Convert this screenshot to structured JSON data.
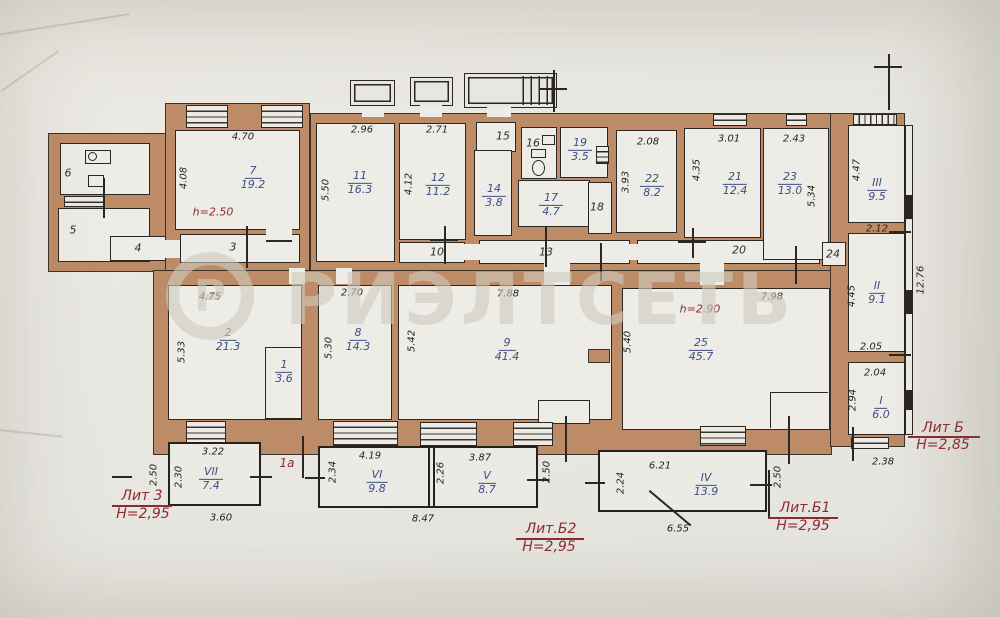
{
  "watermark": {
    "text": "РИЭЛТСЕТЬ",
    "logo_char": "Р"
  },
  "colors": {
    "wall": "#bd8c66",
    "paper": "#e8e7e1",
    "line": "#2b2722",
    "room_label": "#3d4e82",
    "annotation_red": "#8e2b31"
  },
  "room_labels": [
    {
      "n": "7",
      "a": "19.2",
      "x": 253,
      "y": 178
    },
    {
      "n": "11",
      "a": "16.3",
      "x": 360,
      "y": 183
    },
    {
      "n": "12",
      "a": "11.2",
      "x": 438,
      "y": 185
    },
    {
      "n": "14",
      "a": "3.8",
      "x": 494,
      "y": 196
    },
    {
      "n": "19",
      "a": "3.5",
      "x": 580,
      "y": 150
    },
    {
      "n": "17",
      "a": "4.7",
      "x": 551,
      "y": 205
    },
    {
      "n": "22",
      "a": "8.2",
      "x": 652,
      "y": 186
    },
    {
      "n": "21",
      "a": "12.4",
      "x": 735,
      "y": 184
    },
    {
      "n": "23",
      "a": "13.0",
      "x": 790,
      "y": 184
    },
    {
      "n": "III",
      "a": "9.5",
      "x": 877,
      "y": 190
    },
    {
      "n": "II",
      "a": "9.1",
      "x": 877,
      "y": 293
    },
    {
      "n": "I",
      "a": "6.0",
      "x": 881,
      "y": 408
    },
    {
      "n": "2",
      "a": "21.3",
      "x": 228,
      "y": 340
    },
    {
      "n": "1",
      "a": "3.6",
      "x": 284,
      "y": 372
    },
    {
      "n": "8",
      "a": "14.3",
      "x": 358,
      "y": 340
    },
    {
      "n": "9",
      "a": "41.4",
      "x": 507,
      "y": 350
    },
    {
      "n": "25",
      "a": "45.7",
      "x": 701,
      "y": 350
    },
    {
      "n": "VII",
      "a": "7.4",
      "x": 211,
      "y": 479
    },
    {
      "n": "VI",
      "a": "9.8",
      "x": 377,
      "y": 482
    },
    {
      "n": "V",
      "a": "8.7",
      "x": 487,
      "y": 483
    },
    {
      "n": "IV",
      "a": "13.9",
      "x": 706,
      "y": 485
    }
  ],
  "plain_labels": [
    {
      "t": "6",
      "x": 68,
      "y": 173
    },
    {
      "t": "5",
      "x": 73,
      "y": 230
    },
    {
      "t": "4",
      "x": 138,
      "y": 248
    },
    {
      "t": "3",
      "x": 233,
      "y": 247
    },
    {
      "t": "10",
      "x": 437,
      "y": 252
    },
    {
      "t": "13",
      "x": 546,
      "y": 252
    },
    {
      "t": "15",
      "x": 503,
      "y": 136
    },
    {
      "t": "16",
      "x": 533,
      "y": 143
    },
    {
      "t": "18",
      "x": 597,
      "y": 207
    },
    {
      "t": "20",
      "x": 739,
      "y": 250
    },
    {
      "t": "24",
      "x": 833,
      "y": 254
    }
  ],
  "dim_labels": [
    {
      "t": "4.70",
      "x": 243,
      "y": 137,
      "r": 0
    },
    {
      "t": "4.08",
      "x": 184,
      "y": 178,
      "r": 1
    },
    {
      "t": "2.96",
      "x": 362,
      "y": 130,
      "r": 0
    },
    {
      "t": "5.50",
      "x": 326,
      "y": 190,
      "r": 1
    },
    {
      "t": "2.71",
      "x": 437,
      "y": 130,
      "r": 0
    },
    {
      "t": "4.12",
      "x": 409,
      "y": 184,
      "r": 1
    },
    {
      "t": "2.08",
      "x": 648,
      "y": 142,
      "r": 0
    },
    {
      "t": "3.93",
      "x": 626,
      "y": 182,
      "r": 1
    },
    {
      "t": "3.01",
      "x": 729,
      "y": 139,
      "r": 0
    },
    {
      "t": "4.35",
      "x": 697,
      "y": 170,
      "r": 1
    },
    {
      "t": "2.43",
      "x": 794,
      "y": 139,
      "r": 0
    },
    {
      "t": "5.34",
      "x": 812,
      "y": 196,
      "r": 1
    },
    {
      "t": "4.47",
      "x": 857,
      "y": 170,
      "r": 1
    },
    {
      "t": "2.12",
      "x": 877,
      "y": 229,
      "r": 0
    },
    {
      "t": "12.76",
      "x": 921,
      "y": 280,
      "r": 1
    },
    {
      "t": "4.45",
      "x": 852,
      "y": 296,
      "r": 1
    },
    {
      "t": "2.05",
      "x": 871,
      "y": 347,
      "r": 0
    },
    {
      "t": "2.04",
      "x": 875,
      "y": 373,
      "r": 0
    },
    {
      "t": "2.94",
      "x": 853,
      "y": 400,
      "r": 1
    },
    {
      "t": "2.38",
      "x": 883,
      "y": 462,
      "r": 0
    },
    {
      "t": "4.75",
      "x": 210,
      "y": 297,
      "r": 0
    },
    {
      "t": "5.33",
      "x": 182,
      "y": 352,
      "r": 1
    },
    {
      "t": "2.70",
      "x": 352,
      "y": 293,
      "r": 0
    },
    {
      "t": "5.30",
      "x": 329,
      "y": 348,
      "r": 1
    },
    {
      "t": "5.42",
      "x": 412,
      "y": 341,
      "r": 1
    },
    {
      "t": "7.88",
      "x": 508,
      "y": 294,
      "r": 0
    },
    {
      "t": "5.40",
      "x": 628,
      "y": 342,
      "r": 1
    },
    {
      "t": "7.98",
      "x": 772,
      "y": 297,
      "r": 0
    },
    {
      "t": "3.22",
      "x": 213,
      "y": 452,
      "r": 0
    },
    {
      "t": "2.50",
      "x": 154,
      "y": 475,
      "r": 1
    },
    {
      "t": "2.30",
      "x": 179,
      "y": 477,
      "r": 1
    },
    {
      "t": "3.60",
      "x": 221,
      "y": 518,
      "r": 0
    },
    {
      "t": "4.19",
      "x": 370,
      "y": 456,
      "r": 0
    },
    {
      "t": "2.34",
      "x": 333,
      "y": 472,
      "r": 1
    },
    {
      "t": "3.87",
      "x": 480,
      "y": 458,
      "r": 0
    },
    {
      "t": "2.26",
      "x": 441,
      "y": 473,
      "r": 1
    },
    {
      "t": "2.50",
      "x": 547,
      "y": 472,
      "r": 1
    },
    {
      "t": "8.47",
      "x": 423,
      "y": 519,
      "r": 0
    },
    {
      "t": "6.21",
      "x": 660,
      "y": 466,
      "r": 0
    },
    {
      "t": "2.24",
      "x": 621,
      "y": 483,
      "r": 1
    },
    {
      "t": "2.50",
      "x": 778,
      "y": 477,
      "r": 1
    },
    {
      "t": "6.55",
      "x": 678,
      "y": 529,
      "r": 0
    }
  ],
  "red_labels": [
    {
      "t": "h=2.50",
      "x": 213,
      "y": 212,
      "size": 11
    },
    {
      "t": "h=2.90",
      "x": 700,
      "y": 309,
      "size": 11
    },
    {
      "t": "1а",
      "x": 287,
      "y": 463,
      "size": 12
    },
    {
      "t": "Лит 3",
      "x": 142,
      "y": 496,
      "size": 14
    },
    {
      "t": "Н=2,95",
      "x": 143,
      "y": 514,
      "size": 14
    },
    {
      "t": "Лит.Б2",
      "x": 551,
      "y": 529,
      "size": 14
    },
    {
      "t": "Н=2,95",
      "x": 549,
      "y": 547,
      "size": 14
    },
    {
      "t": "Лит.Б1",
      "x": 805,
      "y": 508,
      "size": 14
    },
    {
      "t": "Н=2,95",
      "x": 803,
      "y": 526,
      "size": 14
    },
    {
      "t": "Лит Б",
      "x": 943,
      "y": 428,
      "size": 14
    },
    {
      "t": "Н=2,85",
      "x": 943,
      "y": 445,
      "size": 14
    }
  ]
}
